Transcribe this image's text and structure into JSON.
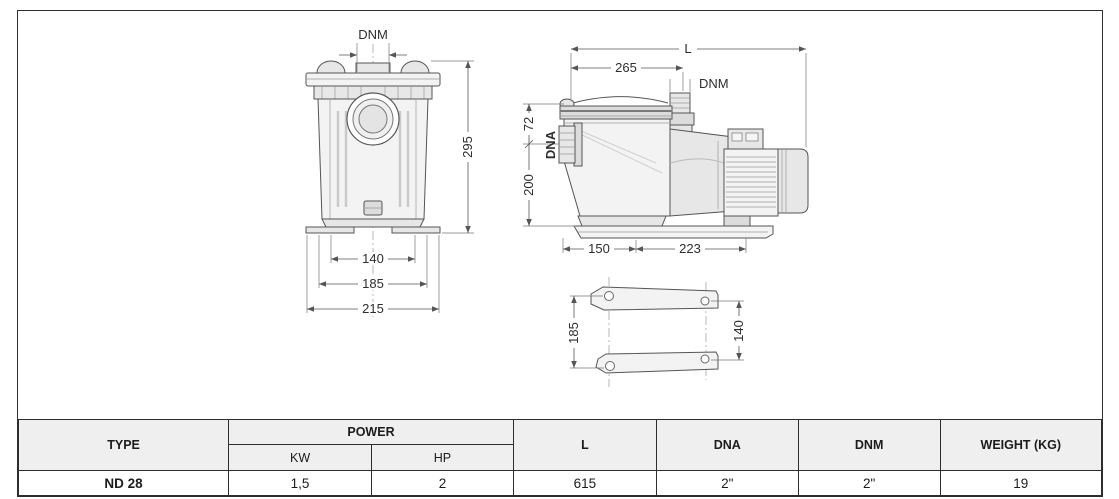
{
  "drawing": {
    "front": {
      "dnm": "DNM",
      "height": "295",
      "w1": "140",
      "w2": "185",
      "w3": "215"
    },
    "side": {
      "l": "L",
      "d265": "265",
      "dnm": "DNM",
      "d72": "72",
      "dna": "DNA",
      "d200": "200",
      "d150": "150",
      "d223": "223"
    },
    "base": {
      "d185": "185",
      "d140": "140"
    }
  },
  "table": {
    "headers": {
      "type": "TYPE",
      "power": "POWER",
      "kw": "KW",
      "hp": "HP",
      "l": "L",
      "dna": "DNA",
      "dnm": "DNM",
      "weight": "WEIGHT (KG)"
    },
    "rows": [
      {
        "type": "ND 28",
        "kw": "1,5",
        "hp": "2",
        "l": "615",
        "dna": "2\"",
        "dnm": "2\"",
        "weight": "19"
      }
    ]
  },
  "colors": {
    "header_bg": "#efefef",
    "table_border": "#2e2e2e",
    "line": "#555555"
  }
}
